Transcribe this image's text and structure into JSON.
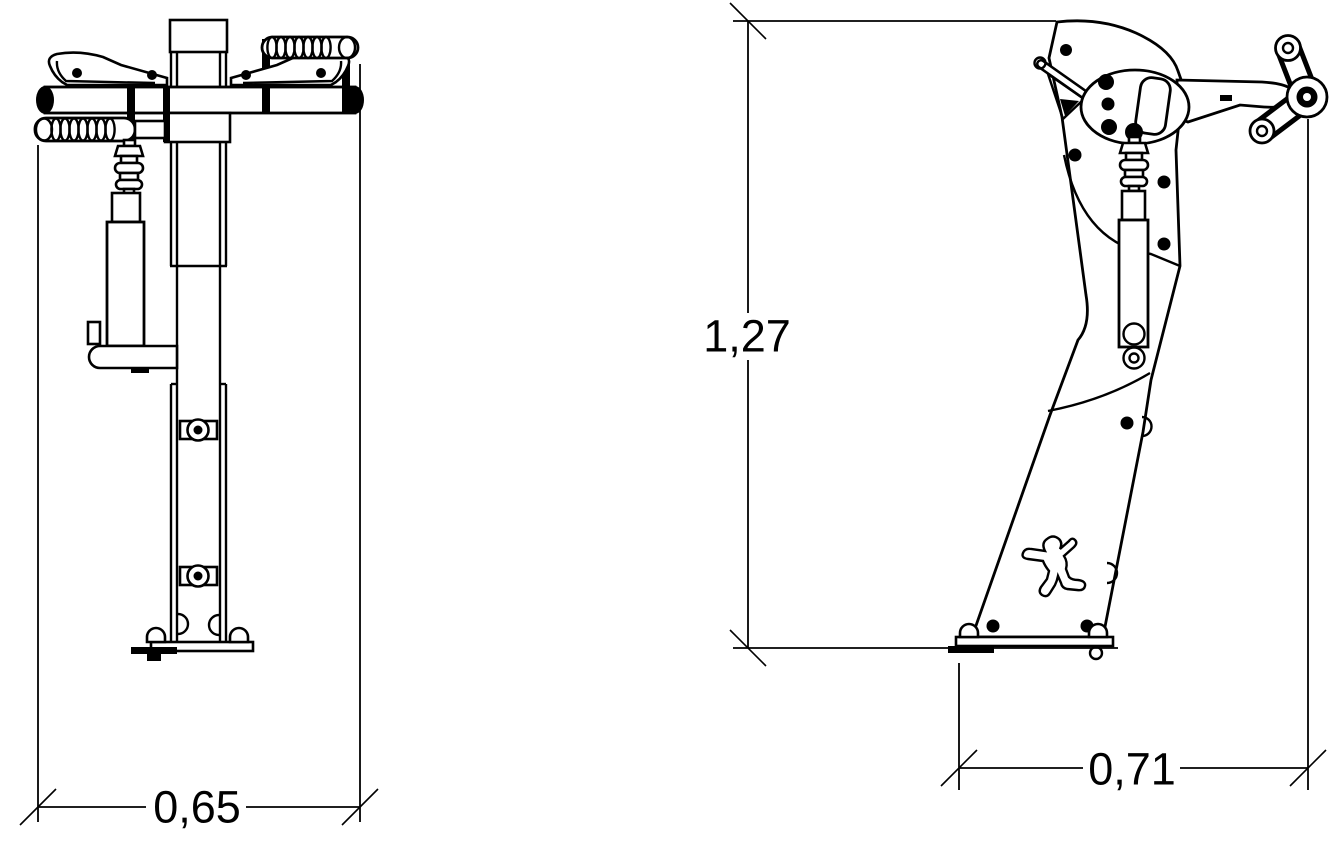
{
  "drawing": {
    "background": "#ffffff",
    "line_color": "#000000",
    "views": {
      "front": {
        "width_label": "0,65"
      },
      "side": {
        "height_label": "1,27",
        "depth_label": "0,71"
      }
    }
  }
}
